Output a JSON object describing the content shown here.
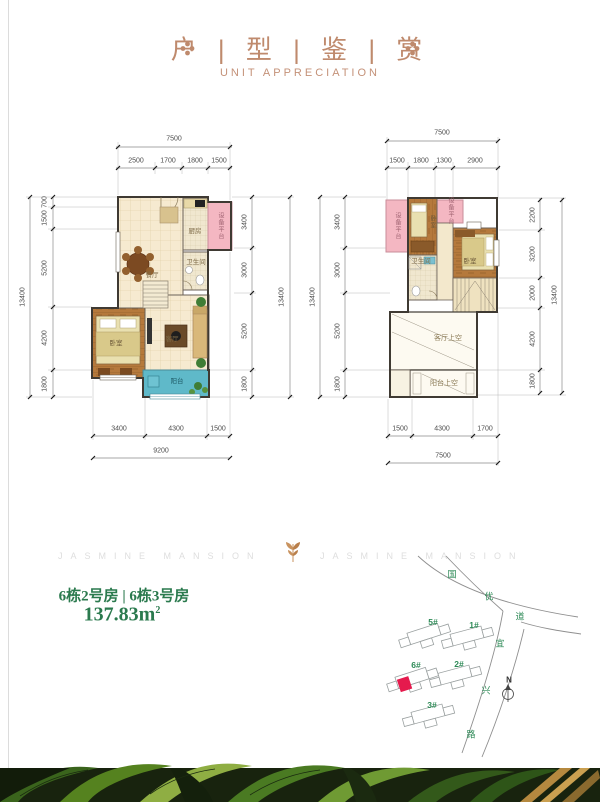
{
  "header": {
    "title": "户 | 型 | 鉴 | 赏",
    "subtitle": "UNIT APPRECIATION",
    "ornament_icon": "flower-ornament",
    "accent_color": "#bf8a6d"
  },
  "watermark": {
    "left_text": "JASMINE MANSION",
    "right_text": "JASMINE MANSION",
    "leaf_icon": "leaf-ornament"
  },
  "unit_info": {
    "name_line": "6栋2号房 | 6栋3号房",
    "area_value": "137.83m",
    "area_sup": "2",
    "color": "#2b7a4e"
  },
  "plan_left": {
    "dim_top_total": "7500",
    "dims_top": [
      "2500",
      "1700",
      "1800",
      "1500"
    ],
    "dim_left_total": "13400",
    "dims_left": [
      "700",
      "1500",
      "5200",
      "4200",
      "1800"
    ],
    "dim_right_total": "13400",
    "dims_right": [
      "3400",
      "3000",
      "5200",
      "1800"
    ],
    "dims_bottom": [
      "3400",
      "4300",
      "1500"
    ],
    "dim_bottom_total": "9200",
    "rooms": {
      "kitchen": "厨房",
      "equipment": "设备平台",
      "bath": "卫生间",
      "dining": "餐厅",
      "living": "客厅",
      "bedroom": "卧室",
      "balcony": "阳台"
    }
  },
  "plan_right": {
    "dim_top_total": "7500",
    "dims_top": [
      "1500",
      "1800",
      "1300",
      "2900"
    ],
    "dim_left_total": "13400",
    "dims_left": [
      "3400",
      "3000",
      "5200",
      "1800"
    ],
    "dim_right_total": "13400",
    "dims_right": [
      "2200",
      "3200",
      "2000",
      "4200",
      "1800"
    ],
    "dims_bottom": [
      "1500",
      "4300",
      "1700"
    ],
    "dim_bottom_total": "7500",
    "rooms": {
      "equipment_left": "设备平台",
      "equipment_top": "设备平台",
      "bedroom_left": "卧室",
      "bath": "卫生间",
      "bedroom_main": "卧室",
      "living_void": "客厅上空",
      "balcony_void": "阳台上空"
    }
  },
  "site_map": {
    "road_a_chars": [
      "国",
      "优",
      "道"
    ],
    "road_b_chars": [
      "宜",
      "兴",
      "路"
    ],
    "buildings": [
      {
        "label": "5#"
      },
      {
        "label": "1#"
      },
      {
        "label": "6#",
        "highlighted": true
      },
      {
        "label": "2#"
      },
      {
        "label": "3#"
      }
    ],
    "compass_label": "N",
    "highlight_color": "#e51a4d",
    "label_color": "#2e8a57"
  }
}
